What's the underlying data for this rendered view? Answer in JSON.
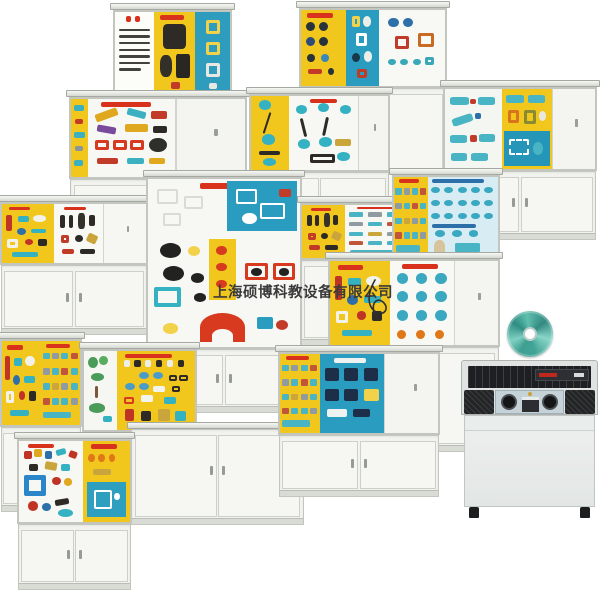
{
  "meta": {
    "description": "Product collage photo: educational mechanism display cabinets, demo CD and control console",
    "background": "#ffffff"
  },
  "watermark": {
    "text": "上海硕博科教设备有限公司",
    "color": "#3a3a3a"
  },
  "palette": {
    "panel_yellow": "#f2c71d",
    "panel_blue": "#2a9cbf",
    "panel_white": "#f7f8f4",
    "cabinet_frame": "#e9ebe6",
    "accent_red": "#d8321c",
    "part_teal": "#3ab2c2",
    "cd_teal": "#4db3a4",
    "console_dark": "#1d1f22"
  },
  "cabinets": [
    {
      "id": "cabinet-sewing-machine-board",
      "x": 113,
      "y": 3,
      "w": 119,
      "h": 250,
      "dh": 87,
      "panels": [
        {
          "w": 34,
          "bg": "#fcfcf8",
          "kind": "text-board"
        },
        {
          "w": 36,
          "bg": "#f2c71d",
          "kind": "sewing-dark"
        },
        {
          "w": 30,
          "bg": "#2e9dbd",
          "kind": "gear-column"
        }
      ]
    },
    {
      "id": "cabinet-gear-mechanism-board",
      "x": 299,
      "y": 1,
      "w": 148,
      "h": 247,
      "dh": 80,
      "panels": [
        {
          "w": 31,
          "bg": "#f2c71d",
          "kind": "dark-circles"
        },
        {
          "w": 23,
          "bg": "#2a9cbf",
          "kind": "circle-board"
        },
        {
          "w": 46,
          "bg": "#f8f9f5",
          "kind": "ring-board"
        }
      ]
    },
    {
      "id": "cabinet-machinery-models",
      "x": 69,
      "y": 90,
      "w": 178,
      "h": 173,
      "dh": 82,
      "panels": [
        {
          "w": 10,
          "bg": "#f2c71d",
          "kind": "teal-strip"
        },
        {
          "w": 50,
          "bg": "#f7f8f4",
          "kind": "machines"
        },
        {
          "w": 40,
          "bg": "#f4f5f1",
          "kind": "door"
        }
      ]
    },
    {
      "id": "cabinet-belt-drives",
      "x": 249,
      "y": 87,
      "w": 141,
      "h": 238,
      "dh": 78,
      "panels": [
        {
          "w": 28,
          "bg": "#f2c71d",
          "kind": "belts-y"
        },
        {
          "w": 50,
          "bg": "#f7f8f4",
          "kind": "belts-w"
        },
        {
          "w": 22,
          "bg": "#f4f5f1",
          "kind": "door"
        }
      ]
    },
    {
      "id": "cabinet-shaft-couplings",
      "x": 443,
      "y": 80,
      "w": 154,
      "h": 160,
      "dh": 84,
      "panels": [
        {
          "w": 38,
          "bg": "#f4f6f2",
          "kind": "shafts"
        },
        {
          "w": 33,
          "bg": "#f2c71d",
          "kind": "gears-blue"
        },
        {
          "w": 29,
          "bg": "#f4f5f1",
          "kind": "door"
        }
      ]
    },
    {
      "id": "cabinet-component-samples",
      "x": 0,
      "y": 195,
      "w": 148,
      "h": 140,
      "dh": 63,
      "panels": [
        {
          "w": 36,
          "bg": "#f2c71d",
          "kind": "mixed"
        },
        {
          "w": 34,
          "bg": "#f8f9f5",
          "kind": "dark-board"
        },
        {
          "w": 30,
          "bg": "#f6f7f3",
          "kind": "door"
        }
      ]
    },
    {
      "id": "cabinet-instrument-dials",
      "x": 146,
      "y": 170,
      "w": 156,
      "h": 243,
      "dh": 172,
      "panels": [
        {
          "w": 100,
          "bg": "#f7f8f4",
          "kind": "dials"
        }
      ]
    },
    {
      "id": "cabinet-tool-parts",
      "x": 300,
      "y": 196,
      "w": 128,
      "h": 150,
      "dh": 57,
      "panels": [
        {
          "w": 35,
          "bg": "#f2c71d",
          "kind": "dark-board"
        },
        {
          "w": 65,
          "bg": "#f7f8f4",
          "kind": "teal-rows"
        }
      ]
    },
    {
      "id": "cabinet-fastener-rows",
      "x": 392,
      "y": 168,
      "w": 108,
      "h": 140,
      "dh": 85,
      "panels": [
        {
          "w": 33,
          "bg": "#f2c71d",
          "kind": "teal-rows"
        },
        {
          "w": 67,
          "bg": "#d8ecf4",
          "kind": "fastener-rows"
        }
      ]
    },
    {
      "id": "cabinet-fastener-grid",
      "x": 328,
      "y": 252,
      "w": 172,
      "h": 200,
      "dh": 88,
      "panels": [
        {
          "w": 36,
          "bg": "#f2c71d",
          "kind": "mixed"
        },
        {
          "w": 38,
          "bg": "#f8f9f5",
          "kind": "fastener-grid"
        },
        {
          "w": 26,
          "bg": "#f4f5f1",
          "kind": "door"
        }
      ]
    },
    {
      "id": "cabinet-small-parts",
      "x": 0,
      "y": 332,
      "w": 82,
      "h": 180,
      "dh": 88,
      "panels": [
        {
          "w": 50,
          "bg": "#f2c71d",
          "kind": "mixed"
        },
        {
          "w": 50,
          "bg": "#f2c71d",
          "kind": "teal-rows"
        }
      ]
    },
    {
      "id": "cabinet-lab-specimens",
      "x": 82,
      "y": 342,
      "w": 115,
      "h": 158,
      "dh": 83,
      "panels": [
        {
          "w": 30,
          "bg": "#f6f7f3",
          "kind": "green-board"
        },
        {
          "w": 70,
          "bg": "#f2c71d",
          "kind": "lab-board"
        }
      ]
    },
    {
      "id": "cabinet-base-only",
      "x": 130,
      "y": 422,
      "w": 175,
      "h": 103,
      "dh": 0,
      "panels": []
    },
    {
      "id": "cabinet-film-slots",
      "x": 278,
      "y": 345,
      "w": 162,
      "h": 152,
      "dh": 83,
      "panels": [
        {
          "w": 25,
          "bg": "#f2c71d",
          "kind": "teal-rows"
        },
        {
          "w": 41,
          "bg": "#2a9cbf",
          "kind": "blue-slots"
        },
        {
          "w": 34,
          "bg": "#f4f5f1",
          "kind": "door"
        }
      ]
    },
    {
      "id": "cabinet-magnetics",
      "x": 17,
      "y": 432,
      "w": 115,
      "h": 158,
      "dh": 85,
      "panels": [
        {
          "w": 58,
          "bg": "#f7f8f4",
          "kind": "magnet-board"
        },
        {
          "w": 42,
          "bg": "#f2c71d",
          "kind": "orange-dots"
        }
      ]
    }
  ],
  "cd": {
    "x": 507,
    "y": 311,
    "size": 46
  },
  "console": {
    "x": 461,
    "y": 360,
    "w": 137,
    "h": 158
  }
}
